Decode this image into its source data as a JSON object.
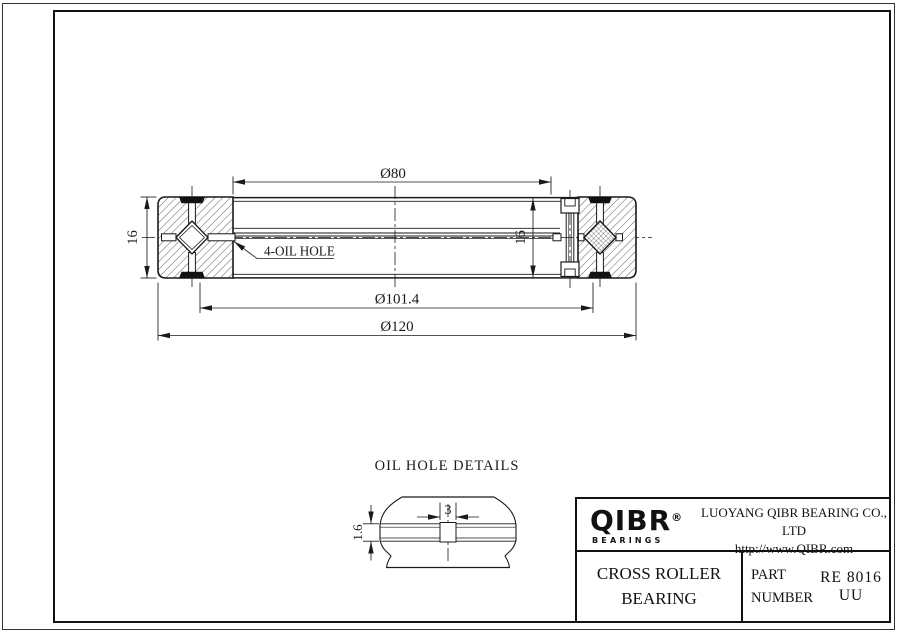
{
  "colors": {
    "line": "#1a1a1a",
    "background": "#ffffff"
  },
  "drawing": {
    "dim_bore": "Ø80",
    "dim_seal": "Ø101.4",
    "dim_outer": "Ø120",
    "dim_height_left": "16",
    "dim_height_inner": "16",
    "oil_hole_label": "4-OIL HOLE"
  },
  "oil_hole_detail": {
    "title": "OIL HOLE DETAILS",
    "dim_width": "3",
    "dim_depth": "1.6"
  },
  "title_block": {
    "logo_text": "QIBR",
    "logo_reg": "®",
    "logo_sub": "BEARINGS",
    "company": "LUOYANG QIBR BEARING CO., LTD",
    "website": "http://www.QIBR.com",
    "product_line1": "CROSS ROLLER",
    "product_line2": "BEARING",
    "part_label1": "PART",
    "part_label2": "NUMBER",
    "part_number": "RE 8016 UU"
  }
}
